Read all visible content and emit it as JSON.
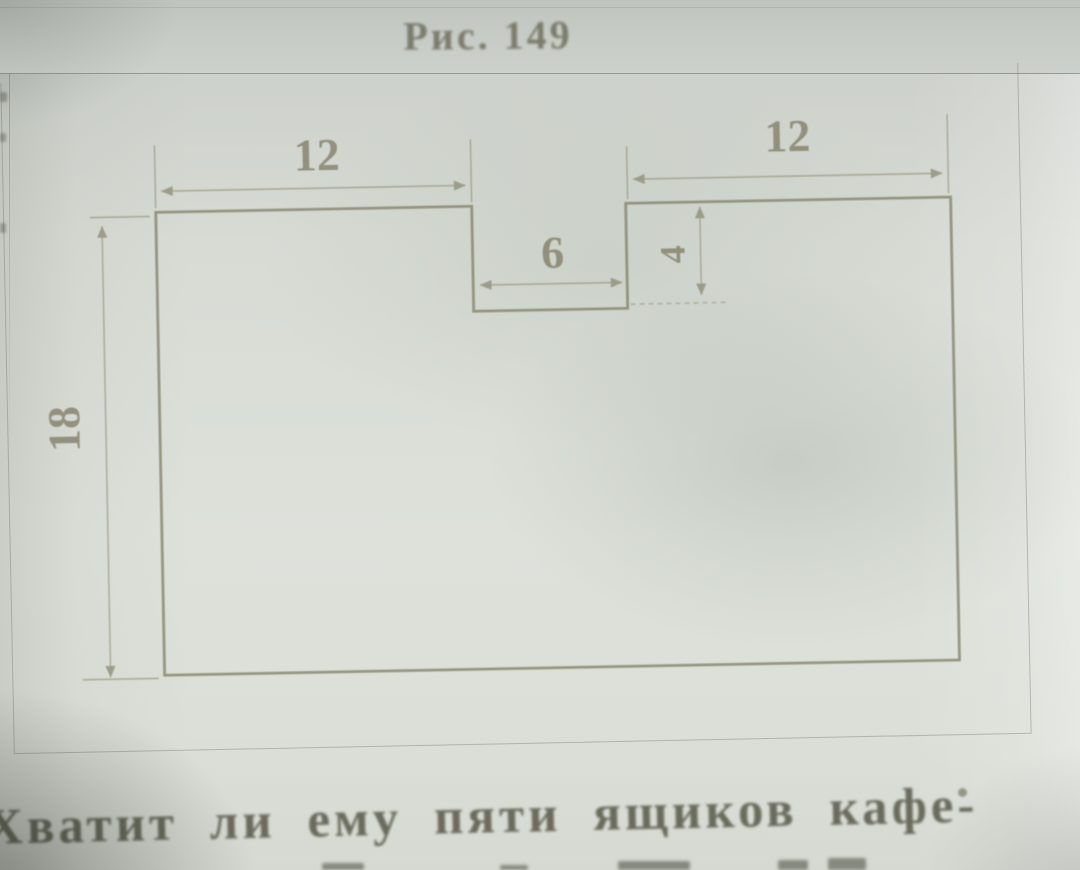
{
  "photo": {
    "caption": "Рис. 149",
    "diagram": {
      "description": "Rectangle with a rectangular notch cut out of the middle of the top edge; dimension lines with arrows mark the widths, notch size and height",
      "line_color": "#87856f",
      "labels": {
        "left_top_width": "12",
        "right_top_width": "12",
        "notch_width": "6",
        "notch_depth": "4",
        "height": "18"
      }
    },
    "body_text": "Хватит ли ему пяти ящиков кафе-"
  }
}
